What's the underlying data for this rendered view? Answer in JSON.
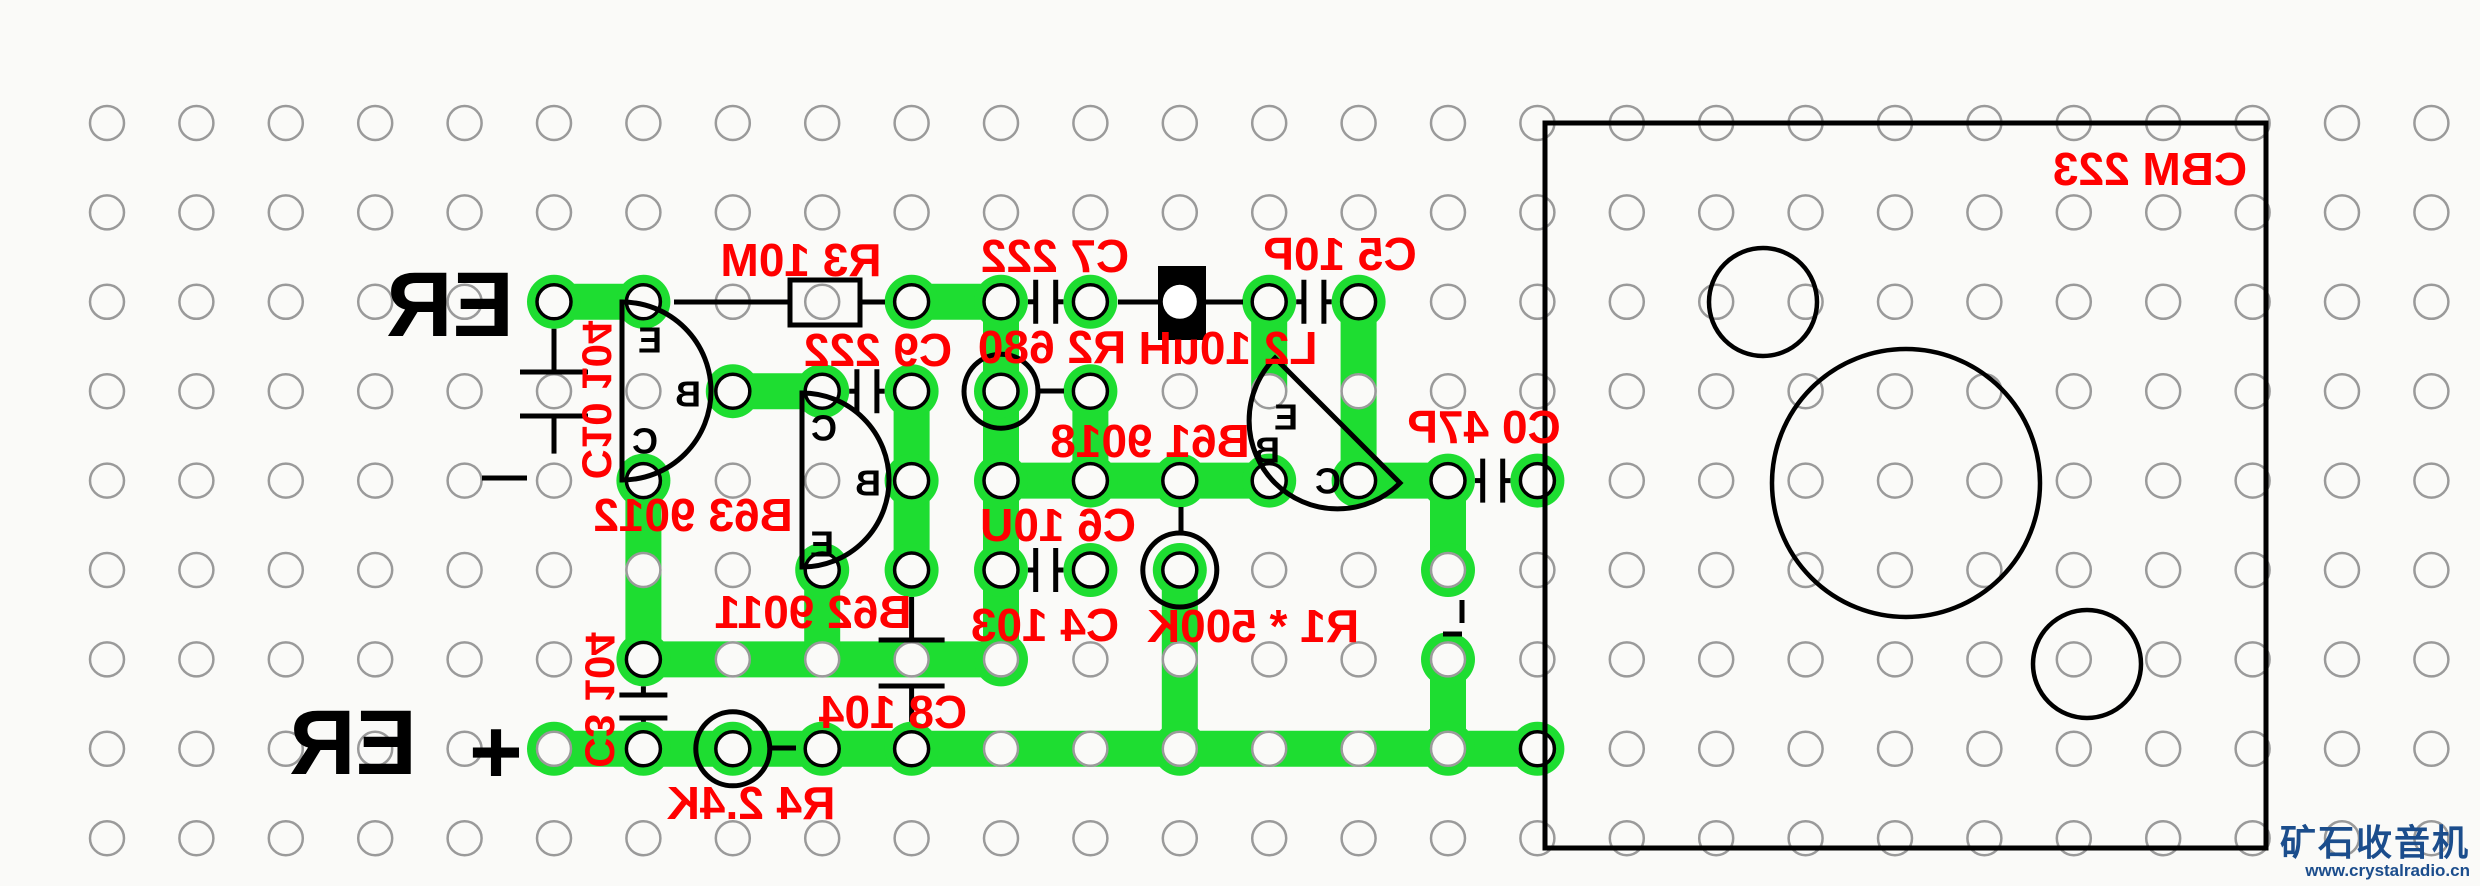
{
  "board": {
    "background": "#fafaf8",
    "trace_color": "#1edd31",
    "trace_width": 36,
    "pad_radius": 27,
    "hole_radius": 17,
    "hole_stroke_plain": "#9a9a9a",
    "hole_stroke_lead": "#000000",
    "grid": {
      "cols": 27,
      "rows": 9,
      "x0": 107,
      "y0": 123,
      "spacing": 89.4
    }
  },
  "traces": [
    {
      "from": [
        5,
        2
      ],
      "to": [
        6,
        2
      ]
    },
    {
      "from": [
        9,
        2
      ],
      "to": [
        10,
        2
      ]
    },
    {
      "from": [
        10,
        2
      ],
      "to": [
        10,
        6
      ]
    },
    {
      "from": [
        6,
        6
      ],
      "to": [
        10,
        6
      ]
    },
    {
      "from": [
        6,
        4
      ],
      "to": [
        6,
        6
      ]
    },
    {
      "from": [
        7,
        3
      ],
      "to": [
        8,
        3
      ]
    },
    {
      "from": [
        9,
        3
      ],
      "to": [
        9,
        5
      ]
    },
    {
      "from": [
        10,
        4
      ],
      "to": [
        13,
        4
      ]
    },
    {
      "from": [
        11,
        3
      ],
      "to": [
        11,
        4
      ]
    },
    {
      "from": [
        13,
        2
      ],
      "to": [
        13,
        3
      ]
    },
    {
      "from": [
        14,
        2
      ],
      "to": [
        14,
        4
      ]
    },
    {
      "from": [
        14,
        4
      ],
      "to": [
        15,
        4
      ]
    },
    {
      "from": [
        15,
        4
      ],
      "to": [
        15,
        5
      ]
    },
    {
      "from": [
        15,
        6
      ],
      "to": [
        15,
        7
      ]
    },
    {
      "from": [
        12,
        5
      ],
      "to": [
        12,
        7
      ]
    },
    {
      "from": [
        8,
        5
      ],
      "to": [
        8,
        6
      ]
    },
    {
      "from": [
        5,
        7
      ],
      "to": [
        16,
        7
      ]
    }
  ],
  "pads": [
    {
      "c": 5,
      "r": 2,
      "lead": true
    },
    {
      "c": 6,
      "r": 2,
      "lead": true
    },
    {
      "c": 9,
      "r": 2,
      "lead": true
    },
    {
      "c": 10,
      "r": 2,
      "lead": true
    },
    {
      "c": 11,
      "r": 2,
      "lead": true
    },
    {
      "c": 13,
      "r": 2,
      "lead": true
    },
    {
      "c": 14,
      "r": 2,
      "lead": true
    },
    {
      "c": 7,
      "r": 3,
      "lead": true
    },
    {
      "c": 8,
      "r": 3,
      "lead": true
    },
    {
      "c": 9,
      "r": 3,
      "lead": true
    },
    {
      "c": 10,
      "r": 3,
      "lead": true,
      "circled": true
    },
    {
      "c": 11,
      "r": 3,
      "lead": true
    },
    {
      "c": 6,
      "r": 4,
      "lead": true
    },
    {
      "c": 9,
      "r": 4,
      "lead": true
    },
    {
      "c": 10,
      "r": 4,
      "lead": true
    },
    {
      "c": 11,
      "r": 4,
      "lead": true
    },
    {
      "c": 12,
      "r": 4,
      "lead": true
    },
    {
      "c": 13,
      "r": 4,
      "lead": true
    },
    {
      "c": 14,
      "r": 4,
      "lead": true
    },
    {
      "c": 15,
      "r": 4,
      "lead": true
    },
    {
      "c": 16,
      "r": 4,
      "lead": true
    },
    {
      "c": 8,
      "r": 5,
      "lead": true
    },
    {
      "c": 9,
      "r": 5,
      "lead": true
    },
    {
      "c": 10,
      "r": 5,
      "lead": true
    },
    {
      "c": 11,
      "r": 5,
      "lead": true
    },
    {
      "c": 12,
      "r": 5,
      "lead": true,
      "circled": true
    },
    {
      "c": 15,
      "r": 5,
      "lead": false
    },
    {
      "c": 6,
      "r": 6,
      "lead": true
    },
    {
      "c": 10,
      "r": 6,
      "lead": false
    },
    {
      "c": 15,
      "r": 6,
      "lead": false
    },
    {
      "c": 5,
      "r": 7,
      "lead": false
    },
    {
      "c": 6,
      "r": 7,
      "lead": true
    },
    {
      "c": 7,
      "r": 7,
      "lead": true,
      "circled": true
    },
    {
      "c": 8,
      "r": 7,
      "lead": true
    },
    {
      "c": 9,
      "r": 7,
      "lead": true
    },
    {
      "c": 12,
      "r": 7,
      "lead": false
    },
    {
      "c": 15,
      "r": 7,
      "lead": false
    },
    {
      "c": 16,
      "r": 7,
      "lead": true
    }
  ],
  "circled_ring_radius": 37,
  "resistor_box": {
    "name": "R3",
    "x": 790,
    "y": 280,
    "w": 70,
    "h": 45
  },
  "inductor_box": {
    "name": "L2",
    "x": 1158,
    "y": 266,
    "w": 48,
    "h": 74,
    "hole": [
      12,
      2
    ]
  },
  "link_lines": [
    [
      674,
      302,
      790,
      302
    ],
    [
      860,
      302,
      885,
      302
    ],
    [
      1118,
      302,
      1158,
      302
    ],
    [
      1206,
      302,
      1243,
      302
    ],
    [
      1039,
      391,
      1064,
      391
    ],
    [
      1181,
      507,
      1181,
      534
    ],
    [
      770,
      748,
      796,
      748
    ],
    [
      482,
      478,
      527,
      478
    ],
    [
      1462,
      600,
      1462,
      623
    ],
    [
      1443,
      634,
      1462,
      634
    ]
  ],
  "capacitors_h": [
    {
      "name": "C7",
      "left": [
        10,
        2
      ],
      "right": [
        11,
        2
      ],
      "bar_half": 22
    },
    {
      "name": "C5",
      "left": [
        13,
        2
      ],
      "right": [
        14,
        2
      ],
      "bar_half": 22
    },
    {
      "name": "C9",
      "left": [
        8,
        3
      ],
      "right": [
        9,
        3
      ],
      "bar_half": 22
    },
    {
      "name": "C4",
      "left": [
        10,
        5
      ],
      "right": [
        11,
        5
      ],
      "bar_half": 22
    },
    {
      "name": "C0",
      "left": [
        15,
        4
      ],
      "right": [
        16,
        4
      ],
      "bar_half": 22
    }
  ],
  "capacitors_v": [
    {
      "name": "C10",
      "top": [
        5,
        2
      ],
      "bot": [
        5,
        4
      ],
      "bars": [
        372,
        416
      ],
      "bar_half": 34
    },
    {
      "name": "C8",
      "top": [
        9,
        5
      ],
      "bot": [
        9,
        7
      ],
      "bars": [
        640,
        686
      ],
      "bar_half": 33
    },
    {
      "name": "C3",
      "top": [
        6,
        6
      ],
      "bot": [
        6,
        7
      ],
      "bars": [
        695,
        718
      ],
      "bar_half": 24
    }
  ],
  "transistors": [
    {
      "name": "B63",
      "path": "M622,302 L622,480 A89 89 0 0 0 622,302 Z",
      "pins": [
        [
          "E",
          650,
          340
        ],
        [
          "B",
          688,
          394
        ],
        [
          "C",
          645,
          441
        ]
      ]
    },
    {
      "name": "B62",
      "path": "M802,393 L802,567 A87 87 0 0 0 802,393 Z",
      "pins": [
        [
          "C",
          824,
          428
        ],
        [
          "B",
          868,
          483
        ],
        [
          "E",
          822,
          544
        ]
      ]
    },
    {
      "name": "B61",
      "path": "M1275,358 L1400,483 A88 88 0 0 1 1275,358 Z",
      "pins": [
        [
          "E",
          1286,
          417
        ],
        [
          "B",
          1267,
          450
        ],
        [
          "C",
          1328,
          481
        ]
      ]
    }
  ],
  "labels": [
    {
      "id": "r3",
      "text": "R3 10M",
      "x": 801,
      "y": 260,
      "size": 46
    },
    {
      "id": "c9",
      "text": "C9 222",
      "x": 878,
      "y": 350,
      "size": 46
    },
    {
      "id": "c7",
      "text": "C7 222",
      "x": 1055,
      "y": 256,
      "size": 46
    },
    {
      "id": "r2",
      "text": "R2 680",
      "x": 1052,
      "y": 347,
      "size": 46
    },
    {
      "id": "l2",
      "text": "L2 10uH",
      "x": 1228,
      "y": 348,
      "size": 46
    },
    {
      "id": "c5",
      "text": "C5 10P",
      "x": 1340,
      "y": 254,
      "size": 46
    },
    {
      "id": "c0",
      "text": "C0 47P",
      "x": 1484,
      "y": 427,
      "size": 46
    },
    {
      "id": "b61",
      "text": "B61 9018",
      "x": 1150,
      "y": 441,
      "size": 46
    },
    {
      "id": "c6",
      "text": "C6 10U",
      "x": 1058,
      "y": 525,
      "size": 46
    },
    {
      "id": "c4",
      "text": "C4 103",
      "x": 1045,
      "y": 625,
      "size": 46
    },
    {
      "id": "r1",
      "text": "R1 * 500K",
      "x": 1253,
      "y": 626,
      "size": 46
    },
    {
      "id": "b63",
      "text": "B63 9012",
      "x": 693,
      "y": 515,
      "size": 46
    },
    {
      "id": "b62",
      "text": "B62 9011",
      "x": 813,
      "y": 612,
      "size": 46
    },
    {
      "id": "c8",
      "text": "C8 104",
      "x": 893,
      "y": 712,
      "size": 46
    },
    {
      "id": "r4",
      "text": "R4 2.4K",
      "x": 751,
      "y": 803,
      "size": 46
    },
    {
      "id": "c10",
      "text": "C10 104",
      "x": 597,
      "y": 400,
      "size": 42,
      "rotate": -90
    },
    {
      "id": "c3",
      "text": "C3 104",
      "x": 600,
      "y": 700,
      "size": 42,
      "rotate": -90
    },
    {
      "id": "cbm",
      "text": "CBM 223",
      "x": 2150,
      "y": 169,
      "size": 46
    }
  ],
  "terminal_labels": [
    {
      "id": "er-top",
      "text": "ER",
      "x": 450,
      "y": 305,
      "size": 92
    },
    {
      "id": "er-bottom",
      "text": "ER",
      "x": 353,
      "y": 743,
      "size": 92
    },
    {
      "id": "plus",
      "text": "+",
      "x": 496,
      "y": 752,
      "size": 92
    }
  ],
  "panel": {
    "name": "CBM-223 tuning capacitor footprint",
    "x": 1545,
    "y": 123,
    "w": 721,
    "h": 725,
    "circles": [
      [
        1763,
        302,
        54
      ],
      [
        1906,
        483,
        134
      ],
      [
        2087,
        664,
        54
      ]
    ]
  },
  "label_color": "#ff0000",
  "watermark": {
    "line1": "矿石收音机",
    "line2": "www.crystalradio.cn",
    "color": "#1b4d8c"
  }
}
